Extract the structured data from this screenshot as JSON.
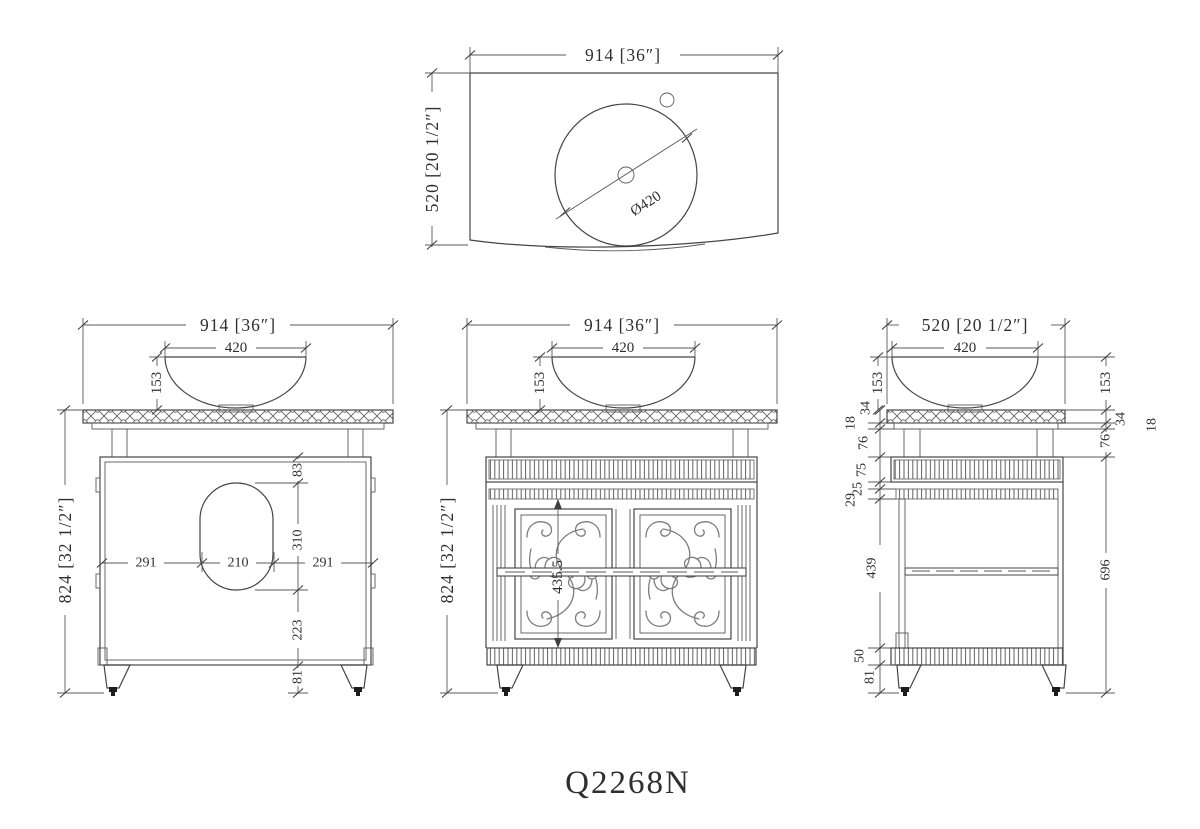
{
  "title": "Q2268N",
  "drawing": {
    "top_view": {
      "width": "914 [36″]",
      "depth": "520 [20 1/2″]",
      "sink_diameter": "Ø420"
    },
    "back_view": {
      "width": "914 [36″]",
      "bowl_width": "420",
      "bowl_height": "153",
      "overall_height": "824 [32 1/2″]",
      "cutout_top_offset": "83",
      "cutout_height": "310",
      "cutout_bottom_offset": "223",
      "leg_height": "81",
      "dist_left": "291",
      "cutout_width": "210",
      "dist_right": "291"
    },
    "front_view": {
      "width": "914 [36″]",
      "bowl_width": "420",
      "bowl_height": "153",
      "overall_height": "824 [32 1/2″]",
      "door_height": "435.5"
    },
    "side_view": {
      "depth": "520 [20 1/2″]",
      "bowl_width": "420",
      "bowl_height_left": "153",
      "bowl_height_right": "153",
      "counter_left": "34",
      "subtop_left": "18",
      "riser_left": "76",
      "top_band": "75",
      "band_gap": "25",
      "trim_strip": "29",
      "counter_right": "34",
      "riser_right": "76",
      "subtop_right": "18",
      "cabinet_with_legs": "696",
      "opening_height": "439",
      "bottom_band": "50",
      "leg_height": "81"
    }
  }
}
